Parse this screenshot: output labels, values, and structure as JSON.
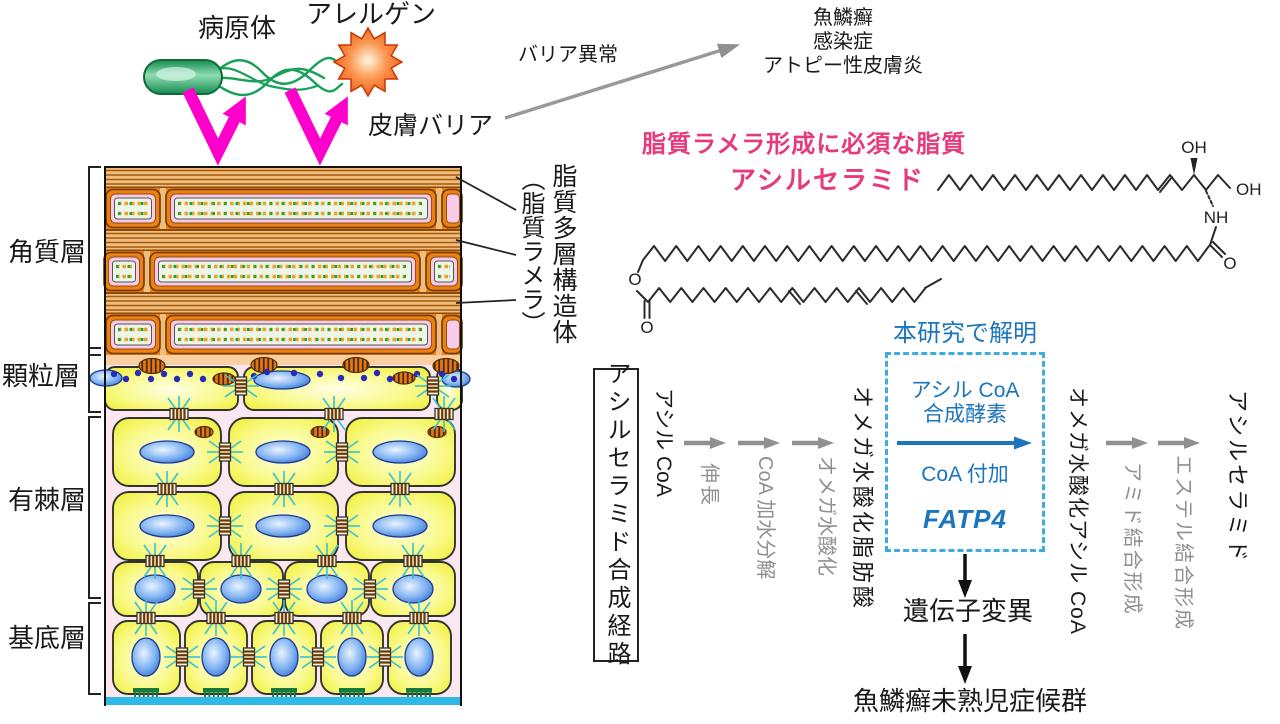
{
  "top_left": {
    "pathogen": "病原体",
    "allergen": "アレルゲン",
    "skin_barrier": "皮膚バリア"
  },
  "top_right": {
    "barrier_abnormality": "バリア異常",
    "diseases": [
      "魚鱗癬",
      "感染症",
      "アトピー性皮膚炎"
    ]
  },
  "skin": {
    "layer_corneum": "角質層",
    "layer_granular": "顆粒層",
    "layer_spinous": "有棘層",
    "layer_basal": "基底層",
    "lamella_structure": "脂質多層構造体",
    "lamella_paren": "（脂質ラメラ）"
  },
  "lipid": {
    "heading": "脂質ラメラ形成に必須な脂質",
    "name": "アシルセラミド",
    "oh_top": "OH",
    "oh_end": "OH",
    "nh": "NH",
    "o_ester": "O",
    "o_ester_carbonyl": "O",
    "o_amide_carbonyl": "O"
  },
  "pathway": {
    "title_box": "アシルセラミド合成経路",
    "discovered": "本研究で解明",
    "node_acyl_coa": "アシル CoA",
    "step_elongation": "伸長",
    "step_coa_hydrolysis": "CoA 加水分解",
    "step_omega_hydroxylation": "オメガ水酸化",
    "node_omega_fa": "オメガ水酸化脂肪酸",
    "enzyme_line1": "アシル CoA",
    "enzyme_line2": "合成酵素",
    "enzyme_reaction": "CoA 付加",
    "enzyme_gene": "FATP4",
    "node_omega_acyl_coa": "オメガ水酸化アシル CoA",
    "step_amide_bond": "アミド結合形成",
    "step_ester_bond": "エステル結合形成",
    "node_acylceramide": "アシルセラミド",
    "mutation": "遺伝子変異",
    "syndrome": "魚鱗癬未熟児症候群"
  },
  "colors": {
    "magenta_arrow": "#ff00cc",
    "pink_heading": "#e73a7c",
    "blue_text": "#1b75bc",
    "blue_dashed_border": "#3fabe3",
    "gray_arrow": "#909090",
    "corneum_orange": "#ee8010",
    "lamella_tan": "#f1bd7d",
    "epidermis_pink_bg": "#fbe7f0",
    "cell_yellow": "#f8f870",
    "basement_cyan": "#30b8e6"
  }
}
